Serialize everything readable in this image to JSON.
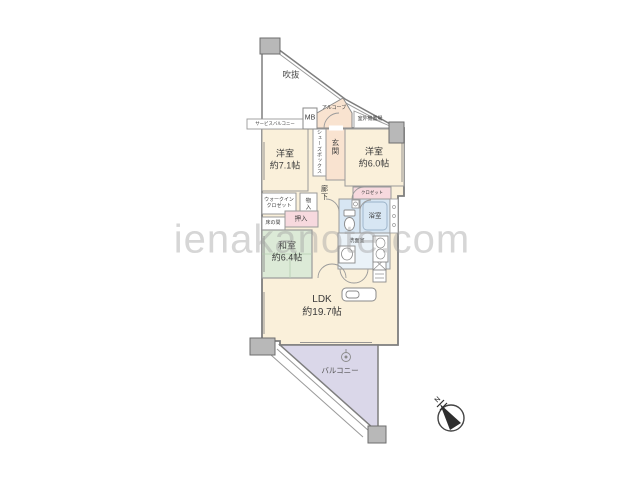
{
  "watermark": "ienakanote.com",
  "compass": {
    "north_label": "N"
  },
  "colors": {
    "room_cream": "#faf0da",
    "entry_peach": "#f9e3d0",
    "tatami_green": "#dcead7",
    "balcony_lavender": "#dad7e9",
    "wet_area_blue": "#d7e6f3",
    "washroom_pale": "#eaf2f8",
    "closet_pink": "#f7d9de",
    "pillar_gray": "#b8b8b8",
    "wall_gray": "#7e7e7e",
    "white": "#ffffff"
  },
  "rooms": {
    "void": {
      "label": "吹抜"
    },
    "alcove": {
      "label": "アルコーブ"
    },
    "meter_box": {
      "label": "MB"
    },
    "outdoor_unit": {
      "label": "室外機置場"
    },
    "service_balcony": {
      "label": "サービスバルコニー"
    },
    "entrance": {
      "label": "玄関"
    },
    "shoe_box": {
      "label": "シューズボックス"
    },
    "western_room_1": {
      "label": "洋室",
      "size": "約7.1帖"
    },
    "western_room_2": {
      "label": "洋室",
      "size": "約6.0帖"
    },
    "hallway": {
      "label": "廊下"
    },
    "walk_in_closet": {
      "label_line1": "ウォークイン",
      "label_line2": "クロゼット"
    },
    "storage": {
      "label": "物入"
    },
    "oshiire": {
      "label": "押入"
    },
    "tokonoma": {
      "label": "床の間"
    },
    "closet": {
      "label": "クロゼット"
    },
    "bathroom": {
      "label": "浴室"
    },
    "washroom": {
      "label": "洗面室"
    },
    "japanese_room": {
      "label": "和室",
      "size": "約6.4帖"
    },
    "ldk": {
      "label": "LDK",
      "size": "約19.7帖"
    },
    "balcony": {
      "label": "バルコニー"
    }
  }
}
